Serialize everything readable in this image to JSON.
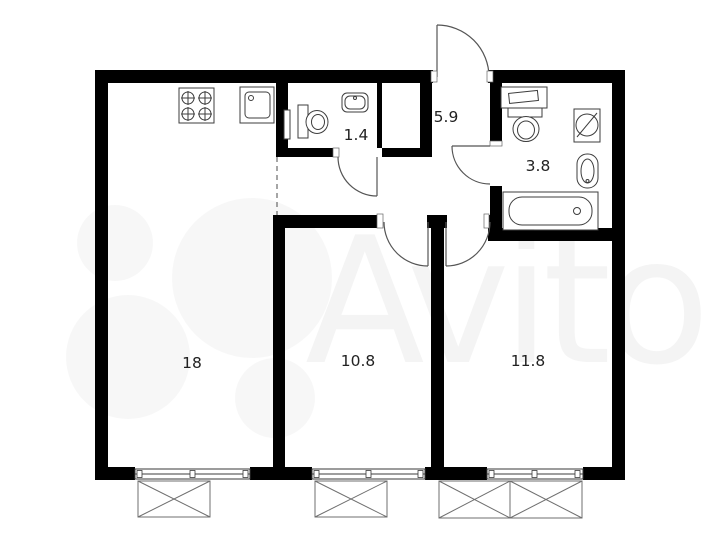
{
  "title": "Apartment floor plan",
  "watermark": {
    "brand": "Avito"
  },
  "rooms": [
    {
      "name": "living-room-kitchen",
      "area": "18"
    },
    {
      "name": "room-middle",
      "area": "10.8"
    },
    {
      "name": "room-right",
      "area": "11.8"
    },
    {
      "name": "hallway",
      "area": "5.9"
    },
    {
      "name": "wc",
      "area": "1.4"
    },
    {
      "name": "bathroom",
      "area": "3.8"
    }
  ],
  "fixtures": [
    "stove-four-burners-icon",
    "kitchen-sink-icon",
    "wc-toilet-icon",
    "wc-sink-icon",
    "bathroom-vanity-sink-icon",
    "bathroom-toilet-icon",
    "washing-machine-icon",
    "bathroom-sink-icon",
    "bathtub-icon"
  ],
  "colors": {
    "wall": "#000000",
    "fixture_stroke": "#3d3d3d",
    "door_stroke": "#555555",
    "label": "#222222",
    "background": "#ffffff"
  }
}
